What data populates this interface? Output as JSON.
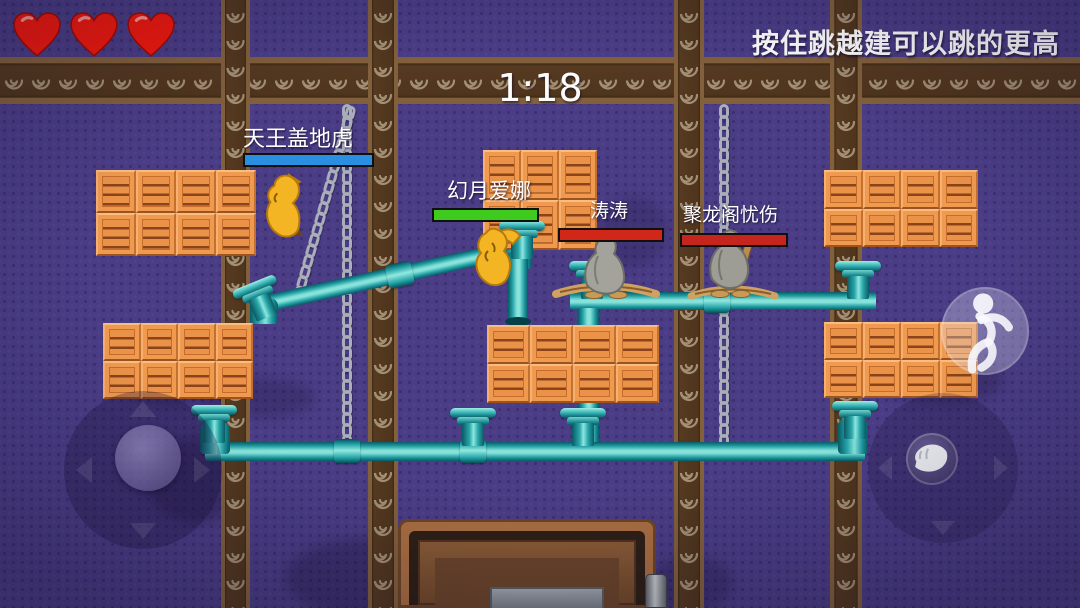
{
  "hud": {
    "timer": "1:18",
    "tip": "按住跳越建可以跳的更高",
    "hearts": {
      "count": 3,
      "color": "#f2190e",
      "outline": "#9f0c04"
    }
  },
  "players": [
    {
      "name": "天王盖地虎",
      "health_color": "#2a8fe0",
      "health_width": "100%"
    },
    {
      "name": "幻月爱娜",
      "health_color": "#3fcb1e",
      "health_width": "100%"
    },
    {
      "name": "涛涛",
      "health_color": "#d02718",
      "health_width": "100%"
    },
    {
      "name": "聚龙阁忧伤",
      "health_color": "#c5251c",
      "health_width": "100%"
    }
  ],
  "controls": {
    "joystick": {
      "icon": "dpad-joystick",
      "arrows": [
        "up",
        "down",
        "left",
        "right"
      ]
    },
    "jump_button": {
      "icon": "jump-figure-icon"
    },
    "grab_button": {
      "icon": "hand-icon"
    }
  },
  "palette": {
    "background": "#4a3d86",
    "beam_wood": "#4f351d",
    "crate_orange": "#f09a50",
    "pipe_teal": "#1d99a0",
    "chain_silver": "#a9aeb9"
  }
}
